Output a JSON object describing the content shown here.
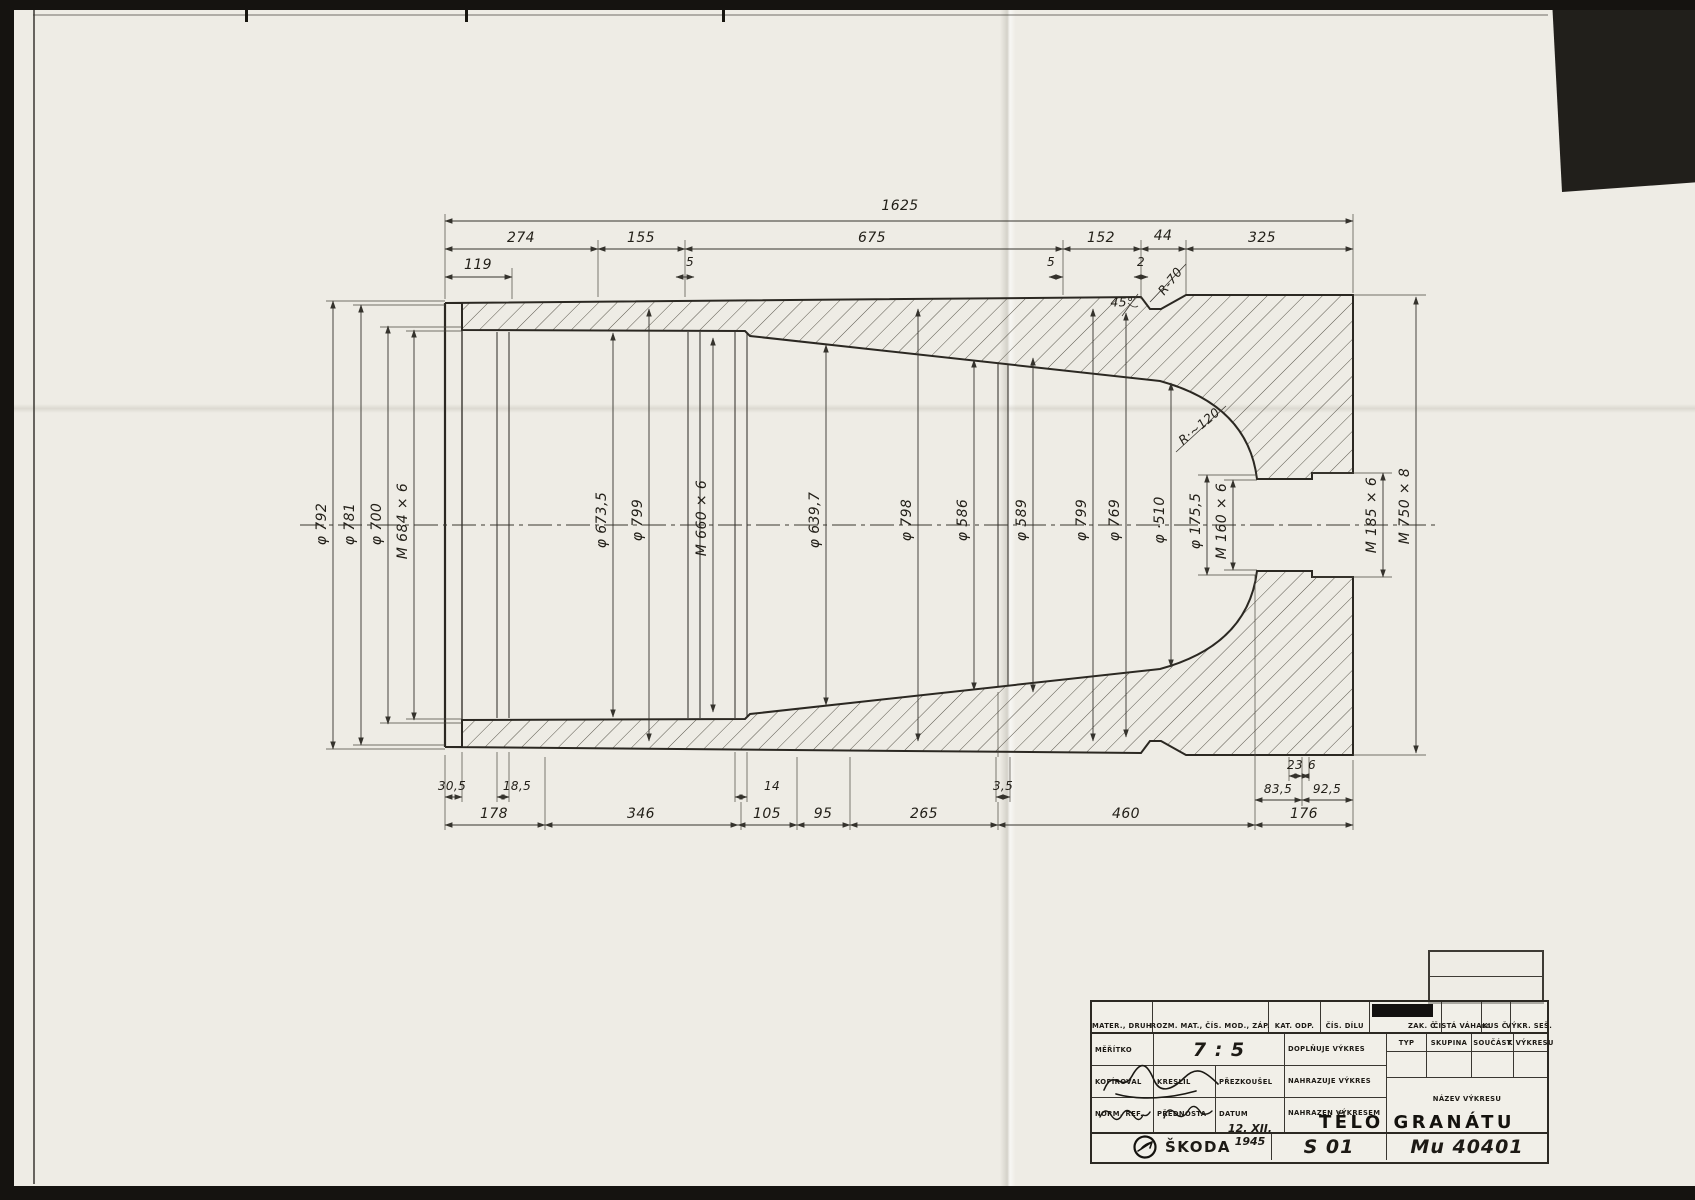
{
  "dims": {
    "top": {
      "total": "1625",
      "s274": "274",
      "s155": "155",
      "s675": "675",
      "s152": "152",
      "s44": "44",
      "s325": "325",
      "s119": "119",
      "s5a": "5",
      "s5b": "5",
      "s2": "2"
    },
    "vertical": [
      "φ 792",
      "φ 781",
      "φ 700",
      "M 684 × 6",
      "φ 673,5",
      "φ 799",
      "M 660 × 6",
      "φ 639,7",
      "φ 798",
      "φ 586",
      "φ 589",
      "φ 799",
      "φ 769",
      "φ ·510",
      "φ 175,5",
      "M 160 × 6",
      "M 185 × 6",
      "M 750 × 8"
    ],
    "bottom": {
      "s305": "30,5",
      "s185": "18,5",
      "s14": "14",
      "s35": "3,5",
      "s835": "83,5",
      "s925": "92,5",
      "s23": "23",
      "s6": "6",
      "s178": "178",
      "s346": "346",
      "s105": "105",
      "s95": "95",
      "s265": "265",
      "s460": "460",
      "s176": "176"
    },
    "annotations": {
      "angle": "45°",
      "r70": "R-70",
      "r120": "R·~120"
    }
  },
  "titleblock": {
    "row1": {
      "mater": "MATER., DRUH",
      "rozm": "ROZM. MAT., ČÍS. MOD., ZÁP.",
      "kat": "KAT. ODP.",
      "cis": "ČÍS. DÍLU",
      "zak": "ZAK. Č.",
      "vaha": "ČISTÁ VÁHA",
      "kg": "KG",
      "kus": "KUS Č.",
      "vykr": "VÝKR. SEŠ."
    },
    "meritko_label": "MĚŘÍTKO",
    "meritko_value": "7 : 5",
    "doplnuje": "DOPLŇUJE VÝKRES",
    "nahrazuje": "NAHRAZUJE VÝKRES",
    "nahrazen": "NAHRAZEN VÝKRESEM",
    "typ": "TYP",
    "skupina": "SKUPINA",
    "soucast": "SOUČÁST",
    "k_vykresu": "K VÝKRESU",
    "kopiroval": "KOPÍROVAL",
    "kreslil": "KRESLIL",
    "prezkousel": "PŘEZKOUŠEL",
    "norm_ref": "NORM. REF.",
    "prednosta": "PŘEDNOSTA",
    "datum_label": "DATUM",
    "datum_value": "12. XII. 1945",
    "nazev_label": "NÁZEV VÝKRESU",
    "title": "TĚLO GRANÁTU",
    "brand": "ŠKODA",
    "sheet": "S 01",
    "drawing_no": "Mu 40401"
  }
}
